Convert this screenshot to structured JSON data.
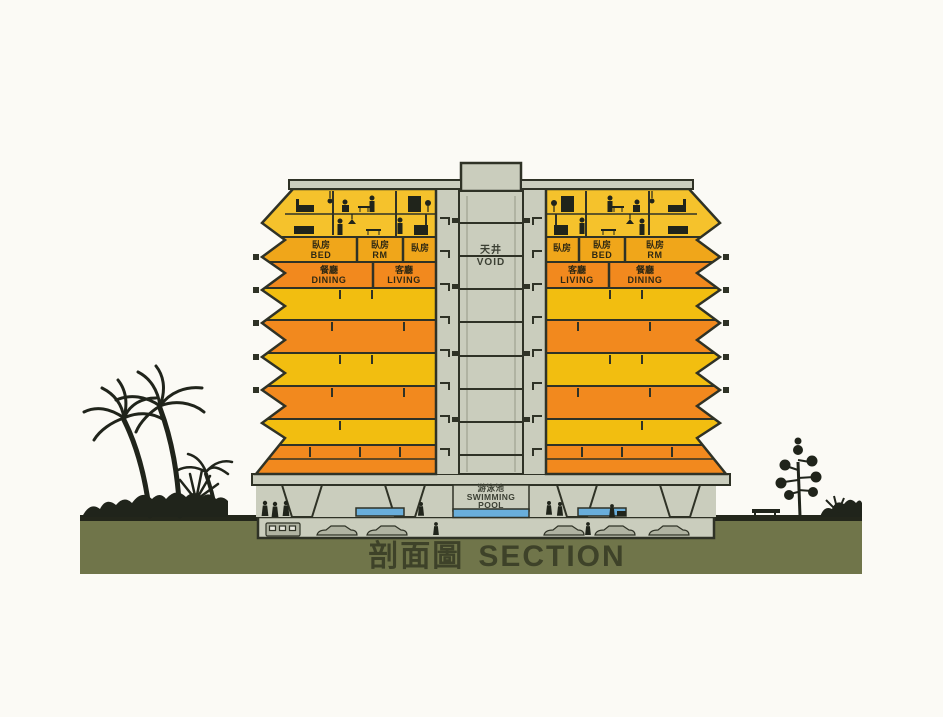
{
  "title": {
    "zh": "剖面圖",
    "en": "SECTION"
  },
  "building": {
    "core": {
      "label_zh": "天井",
      "label_en": "VOID"
    },
    "left_wing": {
      "bedroom_rooms": [
        {
          "zh": "臥房",
          "en": "BED"
        },
        {
          "zh": "臥房",
          "en": "RM"
        },
        {
          "zh": "臥房",
          "en": ""
        }
      ],
      "living_rooms": [
        {
          "zh": "餐廳",
          "en": "DINING"
        },
        {
          "zh": "客廳",
          "en": "LIVING"
        }
      ]
    },
    "right_wing": {
      "bedroom_rooms": [
        {
          "zh": "臥房",
          "en": ""
        },
        {
          "zh": "臥房",
          "en": "BED"
        },
        {
          "zh": "臥房",
          "en": "RM"
        }
      ],
      "living_rooms": [
        {
          "zh": "客廳",
          "en": "LIVING"
        },
        {
          "zh": "餐廳",
          "en": "DINING"
        }
      ]
    },
    "pool": {
      "zh": "游泳池",
      "en_line1": "SWIMMING",
      "en_line2": "POOL"
    }
  },
  "colors": {
    "background": "#FBFAF5",
    "outline": "#2F3226",
    "floor_yellow": "#F2BE10",
    "floor_orange": "#F2891E",
    "scene_yellow": "#F5C22C",
    "bed_amber": "#F0A61A",
    "concrete": "#CACDBD",
    "concrete_shade": "#B0B3A2",
    "ground_olive": "#70754A",
    "ground_dark": "#23261B",
    "pool_blue": "#69AEDB",
    "silhouette": "#20241B",
    "label_text": "#2E2813",
    "title_text": "#3E4229",
    "core_text": "#3C4034",
    "window_glass": "#E8E8DE"
  }
}
